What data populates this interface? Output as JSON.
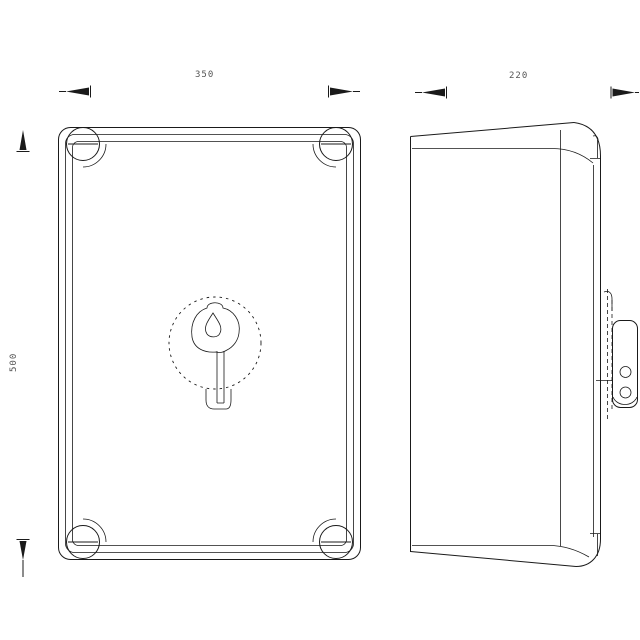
{
  "drawing": {
    "type": "technical-drawing",
    "subject": "wall-mount enclosure, two orthographic views",
    "background_color": "#ffffff",
    "line_color": "#1a1a1a",
    "dim_text_color": "#555555",
    "views": {
      "front": {
        "name": "front-view"
      },
      "side": {
        "name": "side-view"
      }
    },
    "dimensions": {
      "front_width": "350",
      "front_height": "500",
      "side_depth": "220"
    },
    "features": {
      "corner_screw_count": 4,
      "lock": "center key lock with dashed clearance circle",
      "bracket_hole_count": 2
    }
  }
}
